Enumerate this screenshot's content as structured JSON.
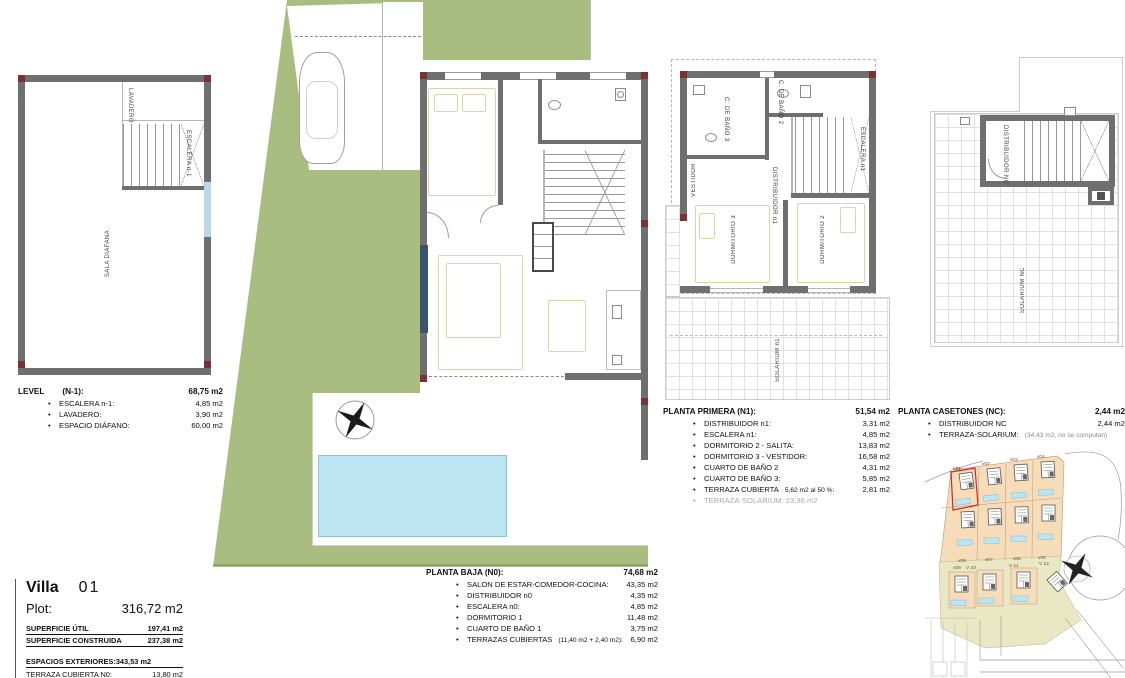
{
  "ui": {
    "bullet": "•"
  },
  "colors": {
    "plot_green": "#a9bd80",
    "pool_blue": "#bce4f2",
    "wall_gray": "#6f6f6f",
    "corner_red": "#7a3333",
    "window_navy": "#3a5570",
    "furniture_tan": "#ddd3ae",
    "site_beige": "#f7dcba",
    "site_olive": "#e9e7c4",
    "highlight_red": "#cc2a1d",
    "tile_line": "#e0e0e0",
    "road_gray": "#9a9a9a"
  },
  "title_block": {
    "villa_label": "Villa",
    "villa_number": "01",
    "plot_label": "Plot:",
    "plot_value": "316,72 m2",
    "summary": [
      {
        "label": "SUPERFICIE ÚTIL",
        "value": "197,41 m2"
      },
      {
        "label": "SUPERFICIE CONSTRUIDA",
        "value": "237,38 m2"
      }
    ],
    "exteriors_header": {
      "label": "ESPACIOS EXTERIORES:",
      "value": "343,53 m2"
    },
    "exteriors": [
      {
        "label": "TERRAZA CUBIERTA N0:",
        "value": "13,80 m2"
      },
      {
        "label": "TERRAZA CUBIERTAS N1:",
        "value": "56,62 m2"
      }
    ]
  },
  "tables": {
    "level_n1": {
      "title": "LEVEL",
      "code": "(N-1):",
      "total": "68,75 m2",
      "items": [
        {
          "label": "ESCALERA n-1:",
          "value": "4,85 m2"
        },
        {
          "label": "LAVADERO:",
          "value": "3,90 m2"
        },
        {
          "label": "ESPACIO DIÁFANO:",
          "value": "60,00 m2"
        }
      ]
    },
    "planta_baja": {
      "title": "PLANTA BAJA (N0):",
      "total": "74,68 m2",
      "items": [
        {
          "label": "SALON DE ESTAR-COMEDOR-COCINA:",
          "value": "43,35 m2"
        },
        {
          "label": "DISTRIBUIDOR n0",
          "value": "4,35 m2"
        },
        {
          "label": "ESCALERA n0:",
          "value": "4,85 m2"
        },
        {
          "label": "DORMITORIO 1",
          "value": "11,48 m2"
        },
        {
          "label": "CUARTO DE BAÑO 1",
          "value": "3,75 m2"
        },
        {
          "label": "TERRAZAS CUBIERTAS",
          "note": "(11,40 m2 + 2,40 m2):",
          "value": "6,90 m2"
        }
      ]
    },
    "planta_primera": {
      "title": "PLANTA PRIMERA (N1):",
      "total": "51,54 m2",
      "items": [
        {
          "label": "DISTRIBUIDOR n1:",
          "value": "3,31 m2"
        },
        {
          "label": "ESCALERA n1:",
          "value": "4,85 m2"
        },
        {
          "label": "DORMITORIO 2 - SALITA:",
          "value": "13,83 m2"
        },
        {
          "label": "DORMITORIO 3 - VESTIDOR:",
          "value": "16,58 m2"
        },
        {
          "label": "CUARTO DE BAÑO 2",
          "value": "4,31 m2"
        },
        {
          "label": "CUARTO DE BAÑO 3:",
          "value": "5,85 m2"
        },
        {
          "label": "TERRAZA CUBIERTA",
          "note": "5,62 m2 al 50 %:",
          "value": "2,81 m2"
        },
        {
          "label": "TERRAZA-SOLARIUM:  23,36 m2",
          "value": "",
          "muted": true
        }
      ]
    },
    "planta_casetones": {
      "title": "PLANTA CASETONES (NC):",
      "total": "2,44 m2",
      "items": [
        {
          "label": "DISTRIBUIDOR NC",
          "value": "2,44 m2"
        },
        {
          "label": "TERRAZA-SOLARIUM:",
          "note": "(34,43 m2, no se computan)",
          "value": ""
        }
      ]
    }
  },
  "plans": {
    "basement": {
      "lavadero": "LAVADERO",
      "escalera": "ESCALERA n-1",
      "sala": "SALA DIÁFANA"
    },
    "primera": {
      "vestidor": "VESTIDOR",
      "bano3": "C. DE BAÑO 3",
      "bano2": "C. DE BAÑO 2",
      "distribuidor": "DISTRIBUIDOR n1",
      "escalera": "ESCALERA n1",
      "dorm3": "DORMITORIO 3",
      "dorm2": "DORMITORIO 2",
      "solarium": "SOLARIUM n1"
    },
    "casetones": {
      "distribuidor": "DISTRIBUIDOR NC",
      "solarium": "SOLARIUM NC"
    }
  },
  "site_plan": {
    "villas": [
      "v01",
      "v02",
      "v03",
      "v04",
      "v05",
      "v06",
      "v07",
      "v08",
      "v09",
      "V 10",
      "V 11",
      "V 12"
    ]
  }
}
